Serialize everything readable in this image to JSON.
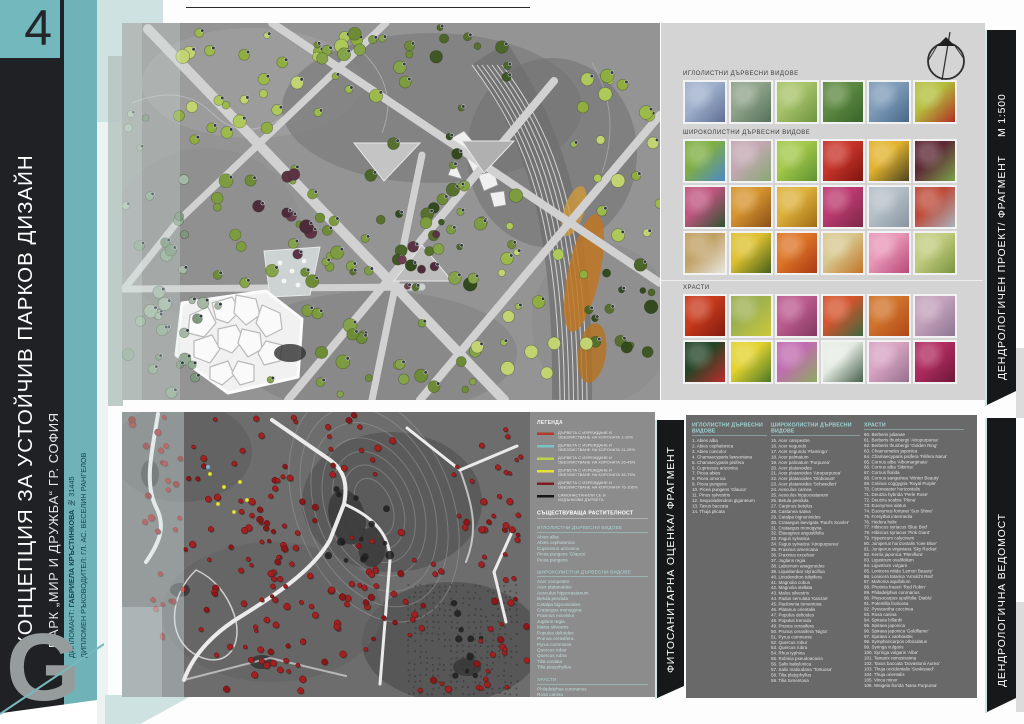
{
  "page": {
    "number": "4"
  },
  "colors": {
    "accent": "#6fb3b8",
    "mint": "#cfe2e2",
    "dark": "#1f2124",
    "band": "#17181a"
  },
  "sidebar": {
    "title": "КОНЦЕПЦИЯ ЗА УСТОЙЧИВ ПАРКОВ ДИЗАЙН",
    "subtitle": "ПАРК „МИР И ДРУЖБА“ ГР. СОФИЯ",
    "credit1_label": "ДИПЛОМАНТ: ",
    "credit1_name": "ГАБРИЕЛА КРЪСТИНКОВА",
    "credit1_number": "  № 31445",
    "credit2": "ДИПЛОМЕН РЪКОВОДИТЕЛ: ГЛ. АС. ВЕСЕЛИН РАНГЕЛОВ",
    "logo_letter": "G"
  },
  "top_panel": {
    "band_label": "ДЕНДРОЛОГИЧЕН ПРОЕКТ/ ФРАГМЕНТ",
    "band_scale": "М 1:500",
    "sections": [
      {
        "title": "ИГЛОЛИСТНИ ДЪРВЕСНИ ВИДОВЕ",
        "tiles": [
          [
            "#9fb0cc",
            "#5f6f93"
          ],
          [
            "#8fa48a",
            "#55705a"
          ],
          [
            "#a7c36a",
            "#6f9440"
          ],
          [
            "#5d8a42",
            "#39642c"
          ],
          [
            "#7f9cb8",
            "#47678a"
          ],
          [
            "#b4bf3e",
            "#b03024"
          ]
        ]
      },
      {
        "title": "ШИРОКОЛИСТНИ ДЪРВЕСНИ ВИДОВЕ",
        "tiles": [
          [
            "#7fae43",
            "#4c88c8"
          ],
          [
            "#c3a8b2",
            "#87a873"
          ],
          [
            "#a3c84a",
            "#5e9230"
          ],
          [
            "#c8352a",
            "#7e1410"
          ],
          [
            "#e2b32e",
            "#4a4420"
          ],
          [
            "#5c2835",
            "#7aa24a"
          ],
          [
            "#c05580",
            "#2e5330"
          ],
          [
            "#d6952f",
            "#8a5018"
          ],
          [
            "#ddb13c",
            "#a06c14"
          ],
          [
            "#bc3a70",
            "#7c2848"
          ],
          [
            "#b5c0c8",
            "#8794a0"
          ],
          [
            "#bd4a38",
            "#a8b2ba"
          ],
          [
            "#c0a063",
            "#e8e6e0"
          ],
          [
            "#ddc02e",
            "#47601c"
          ],
          [
            "#dd7627",
            "#a83a14"
          ],
          [
            "#d8c890",
            "#c07428"
          ],
          [
            "#e898b8",
            "#b84878"
          ],
          [
            "#c2cc80",
            "#7a9440"
          ]
        ]
      },
      {
        "title": "ХРАСТИ",
        "tiles": [
          [
            "#c83a1c",
            "#801c10"
          ],
          [
            "#9cb050",
            "#ccc838"
          ],
          [
            "#bc5c90",
            "#833860"
          ],
          [
            "#d4542c",
            "#3c6840"
          ],
          [
            "#d0742c",
            "#b04818"
          ],
          [
            "#c4a2bc",
            "#8d7694"
          ],
          [
            "#234426",
            "#bc2c2c"
          ],
          [
            "#e2d22e",
            "#4c7828"
          ],
          [
            "#c06cb0",
            "#8caa60"
          ],
          [
            "#e6ece4",
            "#46604a"
          ],
          [
            "#d8a4c4",
            "#96708c"
          ],
          [
            "#b02c60",
            "#6e1838"
          ]
        ]
      }
    ]
  },
  "bottom_panel": {
    "band_label": "ФИТОСАНИТАРНА ОЦЕНКА/ ФРАГМЕНТ",
    "legend": {
      "title": "ЛЕГЕНДА",
      "items": [
        {
          "color": "#b23a30",
          "line1": "ДЪРВЕТА С ИЗРЕЖДАНЕ И",
          "line2": "ОБЕЗЛИСТВАНЕ НА КОРОНАТА 1-10%"
        },
        {
          "color": "#79c3cb",
          "line1": "ДЪРВЕТА С ИЗРЕЖДАНЕ И",
          "line2": "ОБЕЗЛИСТВАНЕ НА КОРОНАТА 11-25%"
        },
        {
          "color": "#bcd24b",
          "line1": "ДЪРВЕТА С ИЗРЕЖДАНЕ И",
          "line2": "ОБЕЗЛИСТВАНЕ НА КОРОНАТА 26-45%"
        },
        {
          "color": "#e9df39",
          "line1": "ДЪРВЕТА С ИЗРЕЖДАНЕ И",
          "line2": "ОБЕЗЛИСТВАНЕ НА КОРОНАТА 46-75%"
        },
        {
          "color": "#7e1d1d",
          "line1": "ДЪРВЕТА С ИЗРЕЖДАНЕ И",
          "line2": "ОБЕЗЛИСТВАНЕ НА КОРОНАТА 76-100%"
        },
        {
          "color": "#161616",
          "line1": "САМОНАСТАНИЛИ СЕ И",
          "line2": "ИЗДЪНКОВИ ДЪРВЕТА"
        }
      ]
    },
    "existing": {
      "title": "СЪЩЕСТВУВАЩА РАСТИТЕЛНОСТ",
      "groups": [
        {
          "title": "ИГЛОЛИСТНИ ДЪРВЕСНИ ВИДОВЕ",
          "items": [
            "Abies alba",
            "Abies cephalonica",
            "Cupressus arizonica",
            "Picea pungens 'Glauca'",
            "Picea pungens"
          ]
        },
        {
          "title": "ШИРОКОЛИСТНИ ДЪРВЕСНИ ВИДОВЕ",
          "items": [
            "Acer campestre",
            "Acer platanoides",
            "Aesculus hippocastanum",
            "Betula pendula",
            "Catalpa bignonioides",
            "Crataegus monogyna",
            "Fraxinus excelsior",
            "Juglans regia",
            "Malus silvestris",
            "Populus deltoides",
            "Prunus cerasifera",
            "Pyrus communis",
            "Quercus robur",
            "Quercus rubra",
            "Tilia cordata",
            "Tilia platyphyllus"
          ]
        },
        {
          "title": "ХРАСТИ",
          "items": [
            "Philadelphus coronarius",
            "Rosa canina",
            "Symphoricarpos orbiculatus",
            "Syringa vulgaris"
          ]
        }
      ]
    }
  },
  "species_list": {
    "band_label": "ДЕНДРОЛОГИЧНА ВЕДОМОСТ",
    "columns": [
      {
        "title": "ИГЛОЛИСТНИ ДЪРВЕСНИ ВИДОВЕ",
        "items": [
          "1. Abies alba",
          "2. Abies cephalonica",
          "3. Abies concolor",
          "4. Chamaecyparis lawsoniana",
          "5. Chamaecyparis pisifera",
          "6. Cupressus arizonica",
          "7. Picea abies",
          "8. Picea omorica",
          "9. Picea pungens",
          "10. Picea pungens 'Glauca'",
          "11. Pinus sylvestris",
          "12. Sequoiadendron giganteum",
          "13. Taxus baccata",
          "14. Thuja plicata"
        ]
      },
      {
        "title": "ШИРОКОЛИСТНИ ДЪРВЕСНИ ВИДОВЕ",
        "items": [
          "15. Acer campestre",
          "16. Acer negundo",
          "17. Acer negundo 'Flamingo'",
          "18. Acer palmatum",
          "19. Acer palmatum 'Purpurea'",
          "20. Acer platanoides",
          "21. Acer platanoides 'Atropurpurea'",
          "22. Acer platanoides 'Globosum'",
          "23. Acer platanoides 'Schwedleri'",
          "24. Aesculus carnea",
          "25. Aesculus hippocastanum",
          "26. Betula pendula",
          "27. Carpinus betulus",
          "28. Castanea sativa",
          "29. Catalpa bignonioides",
          "30. Crataegus laevigata 'Paul's Scarlet'",
          "31. Crataegus monogyna",
          "32. Elaeagnus angustifolia",
          "33. Fagus sylvatica",
          "34. Fagus sylvatica 'Atropurpurea'",
          "35. Fraxinus americana",
          "36. Fraxinus excelsior",
          "37. Juglans regia",
          "38. Laburnum anagyroides",
          "39. Liquidambar styraciflua",
          "40. Liriodendron tulipifera",
          "41. Magnolia cobus",
          "42. Magnolia stellata",
          "43. Malus silvestris",
          "44. Padus serrulata 'Kanzan'",
          "45. Paulownia tomentosa",
          "46. Platanus orientalis",
          "47. Populus deltoides",
          "48. Populus tremula",
          "49. Prunus cerasifera",
          "50. Prunus cerasifera 'Nigra'",
          "51. Pyrus communis",
          "52. Quercus robur",
          "53. Quercus rubra",
          "54. Rhus typhina",
          "55. Robinia pseudoacacia",
          "56. Salix babylonica",
          "57. Salix matsudana 'Tortuosa'",
          "58. Tilia platyphyllus",
          "59. Tilia tomentosa"
        ]
      },
      {
        "title": "ХРАСТИ",
        "items": [
          "60. Berberis julianae",
          "61. Berberis thunbergii 'Atropurpurea'",
          "62. Berberis thunbergii 'Golden Ring'",
          "63. Chaenomeles japonica",
          "64. Chamaecyparis pisifera 'Filifera Nana'",
          "65. Cornus alba 'Albomarginata'",
          "66. Cornus alba 'Sibirica'",
          "67. Cornus florida",
          "68. Cornus sanguinea 'Winter Beauty'",
          "69. Cotinus coggygria 'Royal Purple'",
          "70. Cotoneaster horizontalis",
          "71. Deutzia hybrida 'Perle Rose'",
          "72. Deutzia scabra 'Plena'",
          "73. Euonymus alatus",
          "74. Euonymus fortunei 'Sun Shine'",
          "75. Forsythia intermedia",
          "76. Hedera helix",
          "77. Hibiscus syriacus 'Blue Bird'",
          "78. Hibiscus syriacus 'Pink Giant'",
          "79. Hypericum calycinum",
          "80. Juniperus horizontalis 'Icee Blue'",
          "81. Juniperus virginiana 'Sky Rocket'",
          "82. Kerria japonica 'Pleniflora'",
          "83. Ligustrum ovalifolium",
          "84. Ligustrum vulgare",
          "85. Lonicera nitida 'Lemon Beauty'",
          "86. Lonicera tatarica 'Arnold's Red'",
          "87. Mahonia aquifolium",
          "88. Photinia fraseri 'Red Robin'",
          "89. Philadelphus coronarius",
          "90. Physocarpus opulifolia 'Diablo'",
          "91. Potentilla fruticosa",
          "92. Pyracantha coccinea",
          "93. Rosa canina",
          "94. Spiraea billardii",
          "95. Spiraea japonica",
          "96. Spiraea japonica 'Goldflame'",
          "97. Spiraea x vanhouttei",
          "98. Symphoricarpos orbiculatus",
          "99. Syringa vulgaris",
          "100. Syringa vulgaris 'Alba'",
          "101. Tamarix ramosissima",
          "102. Taxus baccata 'Dovastonii Aurea'",
          "103. Thuja occidentalis 'Sunkissed'",
          "104. Thuja orientalis",
          "105. Vinca minor",
          "106. Weigela florida 'Nana Purpurea'"
        ]
      }
    ]
  }
}
